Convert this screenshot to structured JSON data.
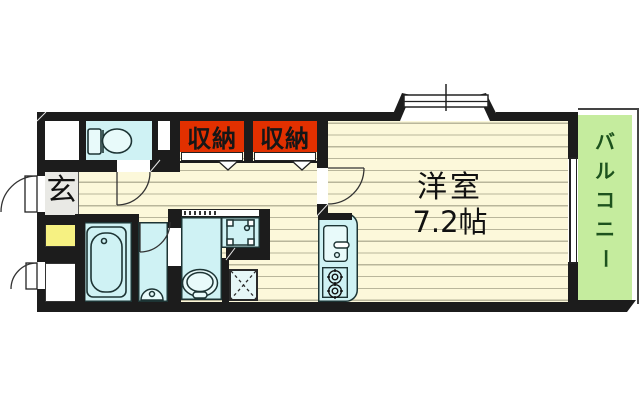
{
  "floor_plan": {
    "labels": {
      "entrance": "玄",
      "closet_left": "収納",
      "closet_right": "収納",
      "main_room_name": "洋室",
      "main_room_size": "7.2帖",
      "balcony": "バルコニー"
    },
    "colors": {
      "wall": "#1c1c1c",
      "flooring": "#fcf8da",
      "flooring_stripe": "#b9b69b",
      "wet_area": "#cff2f4",
      "closet_highlight": "#e23000",
      "balcony": "#c5ec9e",
      "balcony_text": "#1d521d",
      "entrance_tile": "#e9e9e5",
      "shoe_box": "#f6f182"
    },
    "fixtures": [
      "toilet",
      "bathtub",
      "hand-basin",
      "vanity-basin",
      "washing-machine-pan",
      "accordion-door",
      "kitchen-sink",
      "two-burner-stove",
      "refrigerator-space",
      "bay-window",
      "balcony-window",
      "entrance-door",
      "swing-doors",
      "closet-door-markers"
    ]
  }
}
